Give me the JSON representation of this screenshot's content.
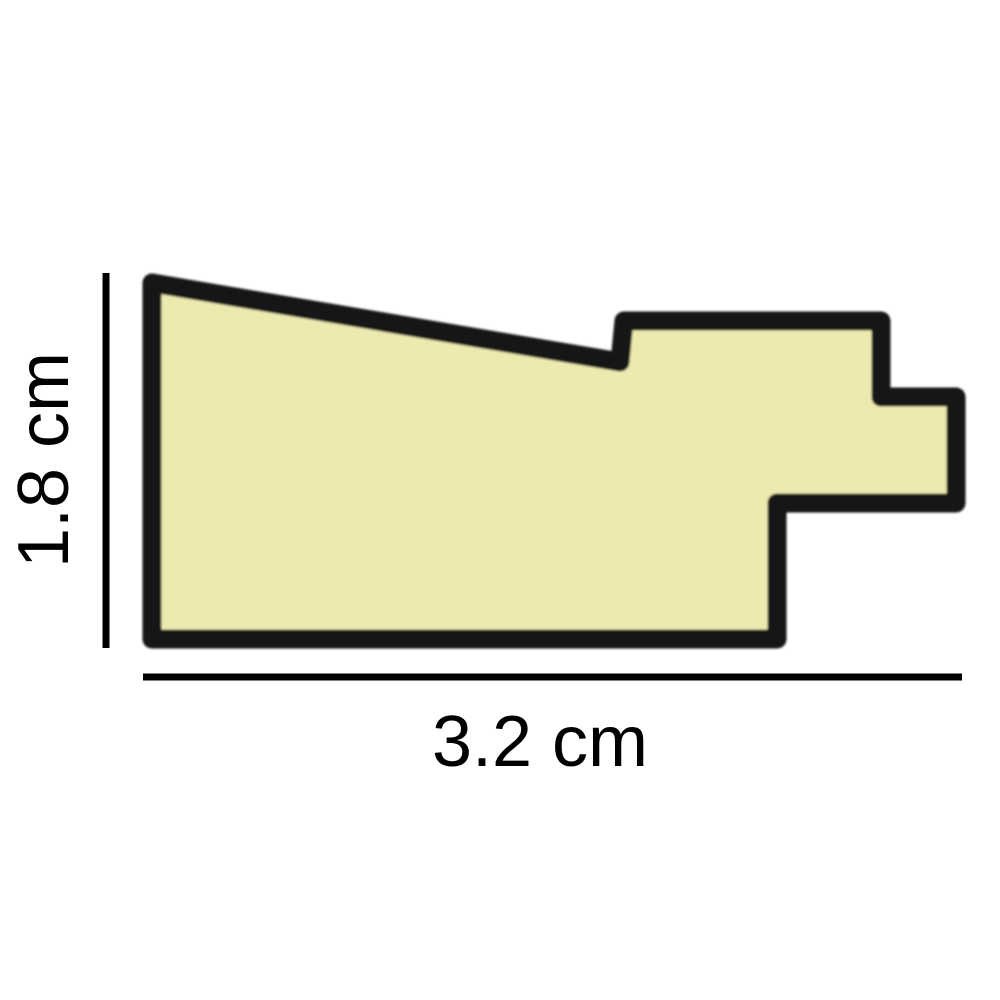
{
  "diagram": {
    "vertical_dimension": {
      "label": "1.8 cm"
    },
    "horizontal_dimension": {
      "label": "3.2 cm"
    }
  },
  "colors": {
    "background": "#FFFFFF",
    "profile_fill": "#EDEAB0",
    "profile_outline": "#141414",
    "dimension_line": "#000000",
    "label_text": "#000000"
  },
  "profile": {
    "points_px": [
      [
        152,
        283
      ],
      [
        620,
        362
      ],
      [
        624,
        321
      ],
      [
        881,
        321
      ],
      [
        881,
        397
      ],
      [
        956,
        397
      ],
      [
        956,
        503
      ],
      [
        777,
        503
      ],
      [
        777,
        639
      ],
      [
        152,
        639
      ]
    ]
  }
}
